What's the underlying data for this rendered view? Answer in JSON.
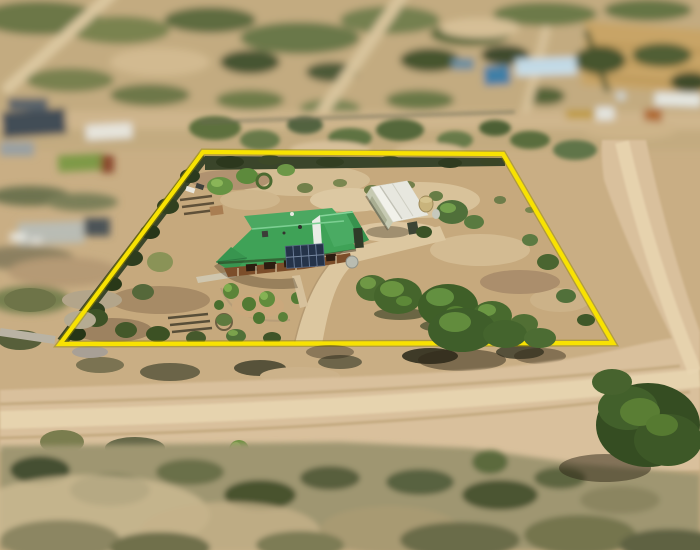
{
  "photo": {
    "kind": "aerial-drone-photograph",
    "alt": "Aerial view of a rural lifestyle property outlined in yellow, with a green-roofed house with solar panels, white shed, rainwater tanks, scattered gum trees, gravel driveway and surrounding dirt roads and farmland (tilt-shift blur at top and bottom)",
    "boundary": {
      "points": "203,152 503,154 613,343 60,344",
      "color": "#f8e202",
      "under_color": "#9a8b00"
    },
    "palette": {
      "ground": "#c9ae84",
      "property_dirt": "#c6a97d",
      "driveway": "#dcc7a0",
      "road": "#d9c09c",
      "road_light": "#e8d6b2",
      "hedge_dark": "#3a452a",
      "scrub_dark": "#3f5e2a",
      "canopy_light": "#6f9845",
      "roof_green": "#3fa257",
      "roof_green_light": "#4ba861",
      "roof_wing": "#4aab63",
      "pavilion_green": "#38954f",
      "gable_white": "#e9ece5",
      "solar_panel": "#253349",
      "timber_wall": "#7c4e2a",
      "shed_roof": "#f1f1ea",
      "shed_wall": "#c6cab2",
      "shed_door": "#a9ae92",
      "tank_tan": "#c9b47c",
      "tank_grey": "#b9bcb1",
      "field_gold": "#c8a466",
      "blue_roof": "#cfe2ec",
      "machinery_blue": "#3f7fa6",
      "truck_white": "#e3e4de",
      "machinery_orange": "#b06a32"
    },
    "features": [
      {
        "name": "property-boundary",
        "label": "yellow lot outline"
      },
      {
        "name": "house",
        "label": "green hip-roof house with solar panels and verandah"
      },
      {
        "name": "shed",
        "label": "white gable shed with roller door and water tank"
      },
      {
        "name": "driveway",
        "label": "gravel driveway"
      },
      {
        "name": "gum-trees",
        "label": "eucalyptus trees"
      },
      {
        "name": "dirt-roads",
        "label": "unsealed roads"
      },
      {
        "name": "neighbour-farm-buildings",
        "label": "blurred farm buildings"
      },
      {
        "name": "paddock",
        "label": "golden harvested field"
      }
    ]
  }
}
